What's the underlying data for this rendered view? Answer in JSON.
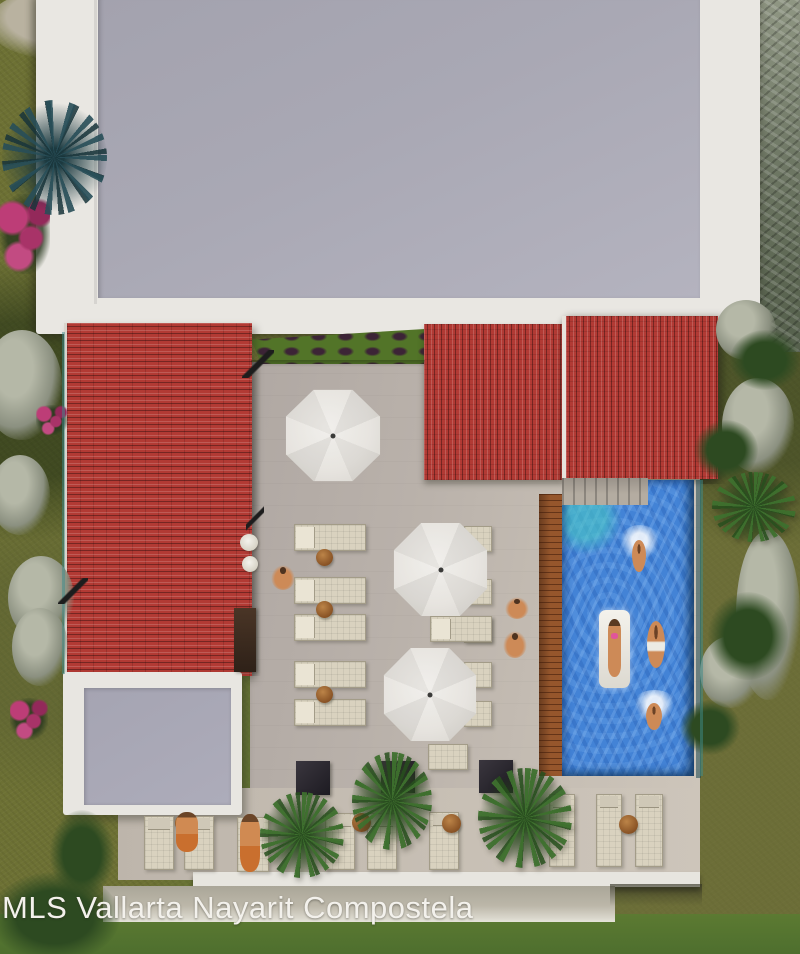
{
  "watermark": {
    "text": "MLS Vallarta Nayarit Compostela"
  },
  "scene": {
    "description": "Aerial top-down 3D architectural rendering of a condo rooftop amenity deck: red tile roofs, grey flat roofs, pool with swimmers, white patio umbrellas, sun loungers, palm trees and lawn",
    "counts": {
      "umbrellas": 3,
      "terrace_loungers": 12,
      "bottom_row_loungers": 9,
      "pool_swimmers": 4,
      "pool_floats": 1,
      "palm_trees": 5,
      "planters": 3,
      "side_tables": 7,
      "people_on_deck": 5
    }
  },
  "palette": {
    "grass": "#6d7134",
    "grass_bright": "#5c7a32",
    "flat_roof_gray": "#a8a7b3",
    "parapet_white": "#e9e7e2",
    "tile_red": "#b23a34",
    "terrace": "#b9b1aa",
    "deck": "#c2bab0",
    "pool_blue": "#4383d6",
    "pool_turquoise": "#49c8c6",
    "wood_edge": "#96562c",
    "lounger_cream": "#d9d2bf",
    "umbrella_white": "#e6e3de",
    "planter_dark": "#211f27",
    "palm_green": "#3a682c",
    "skin": "#cd8a57",
    "watermark_text": "#f3f1ec"
  },
  "items": [
    {
      "t": "rock",
      "name": "rock-patch",
      "x": -18,
      "y": 330,
      "w": 80,
      "h": 110
    },
    {
      "t": "rock",
      "name": "rock-patch",
      "x": -10,
      "y": 455,
      "w": 60,
      "h": 80
    },
    {
      "t": "rock",
      "name": "rock-patch",
      "x": 8,
      "y": 556,
      "w": 66,
      "h": 84
    },
    {
      "t": "rock",
      "name": "rock-patch",
      "x": 12,
      "y": 608,
      "w": 56,
      "h": 78
    },
    {
      "t": "rock",
      "name": "rock-patch",
      "x": 716,
      "y": 300,
      "w": 60,
      "h": 60
    },
    {
      "t": "rock",
      "name": "rock-patch",
      "x": 722,
      "y": 378,
      "w": 72,
      "h": 95
    },
    {
      "t": "rock",
      "name": "rock-patch",
      "x": 736,
      "y": 530,
      "w": 64,
      "h": 170
    },
    {
      "t": "rock",
      "name": "rock-patch",
      "x": 700,
      "y": 636,
      "w": 62,
      "h": 72
    },
    {
      "t": "bush",
      "name": "shrub",
      "x": 730,
      "y": 330,
      "w": 70,
      "h": 60
    },
    {
      "t": "bush",
      "name": "shrub",
      "x": 694,
      "y": 420,
      "w": 64,
      "h": 60
    },
    {
      "t": "bush",
      "name": "shrub",
      "x": 708,
      "y": 592,
      "w": 80,
      "h": 88
    },
    {
      "t": "bush",
      "name": "shrub",
      "x": 680,
      "y": 700,
      "w": 60,
      "h": 55
    },
    {
      "t": "bush",
      "name": "shrub",
      "x": -10,
      "y": 872,
      "w": 130,
      "h": 90
    },
    {
      "t": "bush",
      "name": "shrub",
      "x": 50,
      "y": 810,
      "w": 64,
      "h": 88
    },
    {
      "t": "flowers",
      "name": "pink-flower-bed",
      "x": 0,
      "y": 194,
      "w": 50,
      "h": 80
    },
    {
      "t": "flowers",
      "name": "pink-flower-bed",
      "x": 36,
      "y": 405,
      "w": 32,
      "h": 30
    },
    {
      "t": "flowers",
      "name": "pink-flower-bed",
      "x": 10,
      "y": 698,
      "w": 38,
      "h": 42
    },
    {
      "t": "rail",
      "name": "glass-railing",
      "x": 62,
      "y": 332,
      "w": 3,
      "h": 342
    },
    {
      "t": "rail",
      "name": "glass-railing",
      "x": 700,
      "y": 480,
      "w": 3,
      "h": 296
    },
    {
      "t": "steps",
      "name": "pool-steps",
      "x": 562,
      "y": 478,
      "w": 86,
      "h": 27
    },
    {
      "t": "lounger-h",
      "name": "sun-lounger",
      "x": 294,
      "y": 524,
      "w": 72,
      "h": 27
    },
    {
      "t": "lounger-h",
      "name": "sun-lounger",
      "x": 294,
      "y": 577,
      "w": 72,
      "h": 27
    },
    {
      "t": "lounger-h",
      "name": "sun-lounger",
      "x": 294,
      "y": 614,
      "w": 72,
      "h": 27
    },
    {
      "t": "lounger-h",
      "name": "sun-lounger",
      "x": 294,
      "y": 661,
      "w": 72,
      "h": 27
    },
    {
      "t": "lounger-h",
      "name": "sun-lounger",
      "x": 294,
      "y": 699,
      "w": 72,
      "h": 27
    },
    {
      "t": "lounger-r",
      "name": "sun-lounger",
      "x": 464,
      "y": 526,
      "w": 28,
      "h": 26
    },
    {
      "t": "lounger-r",
      "name": "sun-lounger",
      "x": 464,
      "y": 579,
      "w": 28,
      "h": 26
    },
    {
      "t": "lounger-r",
      "name": "sun-lounger",
      "x": 464,
      "y": 617,
      "w": 28,
      "h": 26
    },
    {
      "t": "lounger-r",
      "name": "sun-lounger",
      "x": 464,
      "y": 662,
      "w": 28,
      "h": 26
    },
    {
      "t": "lounger-r",
      "name": "sun-lounger",
      "x": 464,
      "y": 701,
      "w": 28,
      "h": 26
    },
    {
      "t": "lounger-h",
      "name": "sun-lounger",
      "x": 430,
      "y": 616,
      "w": 62,
      "h": 26
    },
    {
      "t": "lounger-r",
      "name": "sun-lounger",
      "x": 428,
      "y": 744,
      "w": 40,
      "h": 26
    },
    {
      "t": "lounger-v",
      "name": "sun-lounger",
      "x": 144,
      "y": 816,
      "w": 30,
      "h": 54
    },
    {
      "t": "lounger-v",
      "name": "sun-lounger",
      "x": 184,
      "y": 816,
      "w": 30,
      "h": 54
    },
    {
      "t": "lounger-v",
      "name": "sun-lounger",
      "x": 237,
      "y": 817,
      "w": 32,
      "h": 55
    },
    {
      "t": "lounger-v",
      "name": "sun-lounger",
      "x": 325,
      "y": 813,
      "w": 30,
      "h": 57
    },
    {
      "t": "lounger-v",
      "name": "sun-lounger",
      "x": 367,
      "y": 813,
      "w": 30,
      "h": 57
    },
    {
      "t": "lounger-v",
      "name": "sun-lounger",
      "x": 429,
      "y": 812,
      "w": 30,
      "h": 58
    },
    {
      "t": "lounger-v",
      "name": "sun-lounger",
      "x": 549,
      "y": 794,
      "w": 26,
      "h": 73
    },
    {
      "t": "lounger-v",
      "name": "sun-lounger",
      "x": 596,
      "y": 794,
      "w": 26,
      "h": 73
    },
    {
      "t": "lounger-v",
      "name": "sun-lounger",
      "x": 635,
      "y": 794,
      "w": 28,
      "h": 73
    },
    {
      "t": "table-round",
      "name": "side-table",
      "x": 316,
      "y": 549,
      "w": 17,
      "h": 17
    },
    {
      "t": "table-round",
      "name": "side-table",
      "x": 316,
      "y": 601,
      "w": 17,
      "h": 17
    },
    {
      "t": "table-round",
      "name": "side-table",
      "x": 316,
      "y": 686,
      "w": 17,
      "h": 17
    },
    {
      "t": "table-round",
      "name": "side-table",
      "x": 175,
      "y": 814,
      "w": 18,
      "h": 18
    },
    {
      "t": "table-round",
      "name": "side-table",
      "x": 352,
      "y": 813,
      "w": 19,
      "h": 19
    },
    {
      "t": "table-round",
      "name": "side-table",
      "x": 442,
      "y": 814,
      "w": 19,
      "h": 19
    },
    {
      "t": "table-round",
      "name": "side-table",
      "x": 619,
      "y": 815,
      "w": 19,
      "h": 19
    },
    {
      "t": "planter",
      "name": "dark-planter",
      "x": 296,
      "y": 761,
      "w": 34,
      "h": 34
    },
    {
      "t": "planter",
      "name": "dark-planter",
      "x": 381,
      "y": 761,
      "w": 34,
      "h": 32
    },
    {
      "t": "planter",
      "name": "dark-planter",
      "x": 479,
      "y": 760,
      "w": 34,
      "h": 33
    },
    {
      "t": "chair-white",
      "name": "pool-chair",
      "x": 240,
      "y": 534,
      "w": 18,
      "h": 17
    },
    {
      "t": "chair-white",
      "name": "pool-chair",
      "x": 242,
      "y": 556,
      "w": 16,
      "h": 16
    },
    {
      "t": "bar-wood",
      "name": "bar-counter",
      "x": 234,
      "y": 608,
      "w": 22,
      "h": 64
    },
    {
      "t": "stick",
      "name": "pole-shadow",
      "x": 242,
      "y": 350,
      "w": 32,
      "h": 28
    },
    {
      "t": "stick",
      "name": "pole-shadow",
      "x": 246,
      "y": 505,
      "w": 18,
      "h": 26
    },
    {
      "t": "stick",
      "name": "pole-shadow",
      "x": 58,
      "y": 578,
      "w": 30,
      "h": 26
    },
    {
      "t": "umbrella",
      "name": "patio-umbrella",
      "x": 284,
      "y": 388,
      "w": 98,
      "h": 95
    },
    {
      "t": "umbrella",
      "name": "patio-umbrella",
      "x": 392,
      "y": 521,
      "w": 97,
      "h": 97
    },
    {
      "t": "umbrella",
      "name": "patio-umbrella",
      "x": 382,
      "y": 646,
      "w": 96,
      "h": 97
    },
    {
      "t": "palm-dark",
      "name": "palm-tree",
      "x": 2,
      "y": 100,
      "w": 105,
      "h": 115
    },
    {
      "t": "palm",
      "name": "palm-tree",
      "x": 260,
      "y": 792,
      "w": 84,
      "h": 86
    },
    {
      "t": "palm",
      "name": "palm-tree",
      "x": 352,
      "y": 752,
      "w": 80,
      "h": 98
    },
    {
      "t": "palm",
      "name": "palm-tree",
      "x": 478,
      "y": 768,
      "w": 94,
      "h": 100
    },
    {
      "t": "palm",
      "name": "palm-tree",
      "x": 712,
      "y": 472,
      "w": 84,
      "h": 70
    },
    {
      "t": "person",
      "name": "person-standing",
      "x": 271,
      "y": 565,
      "w": 24,
      "h": 25
    },
    {
      "t": "person",
      "name": "person-standing",
      "x": 505,
      "y": 597,
      "w": 24,
      "h": 22
    },
    {
      "t": "person",
      "name": "person-standing",
      "x": 503,
      "y": 631,
      "w": 24,
      "h": 27
    },
    {
      "t": "person-lying",
      "name": "person-sunbathing",
      "x": 176,
      "y": 812,
      "w": 22,
      "h": 40
    },
    {
      "t": "person-lying",
      "name": "person-sunbathing",
      "x": 240,
      "y": 814,
      "w": 20,
      "h": 58
    },
    {
      "t": "swimmer",
      "name": "pool-swimmer",
      "x": 626,
      "y": 534,
      "w": 26,
      "h": 42
    },
    {
      "t": "swimmer-shorts",
      "name": "pool-swimmer",
      "x": 640,
      "y": 612,
      "w": 32,
      "h": 62
    },
    {
      "t": "swimmer",
      "name": "pool-swimmer",
      "x": 640,
      "y": 698,
      "w": 28,
      "h": 36
    },
    {
      "t": "float",
      "name": "pool-float-with-person",
      "x": 599,
      "y": 610,
      "w": 31,
      "h": 78
    }
  ]
}
